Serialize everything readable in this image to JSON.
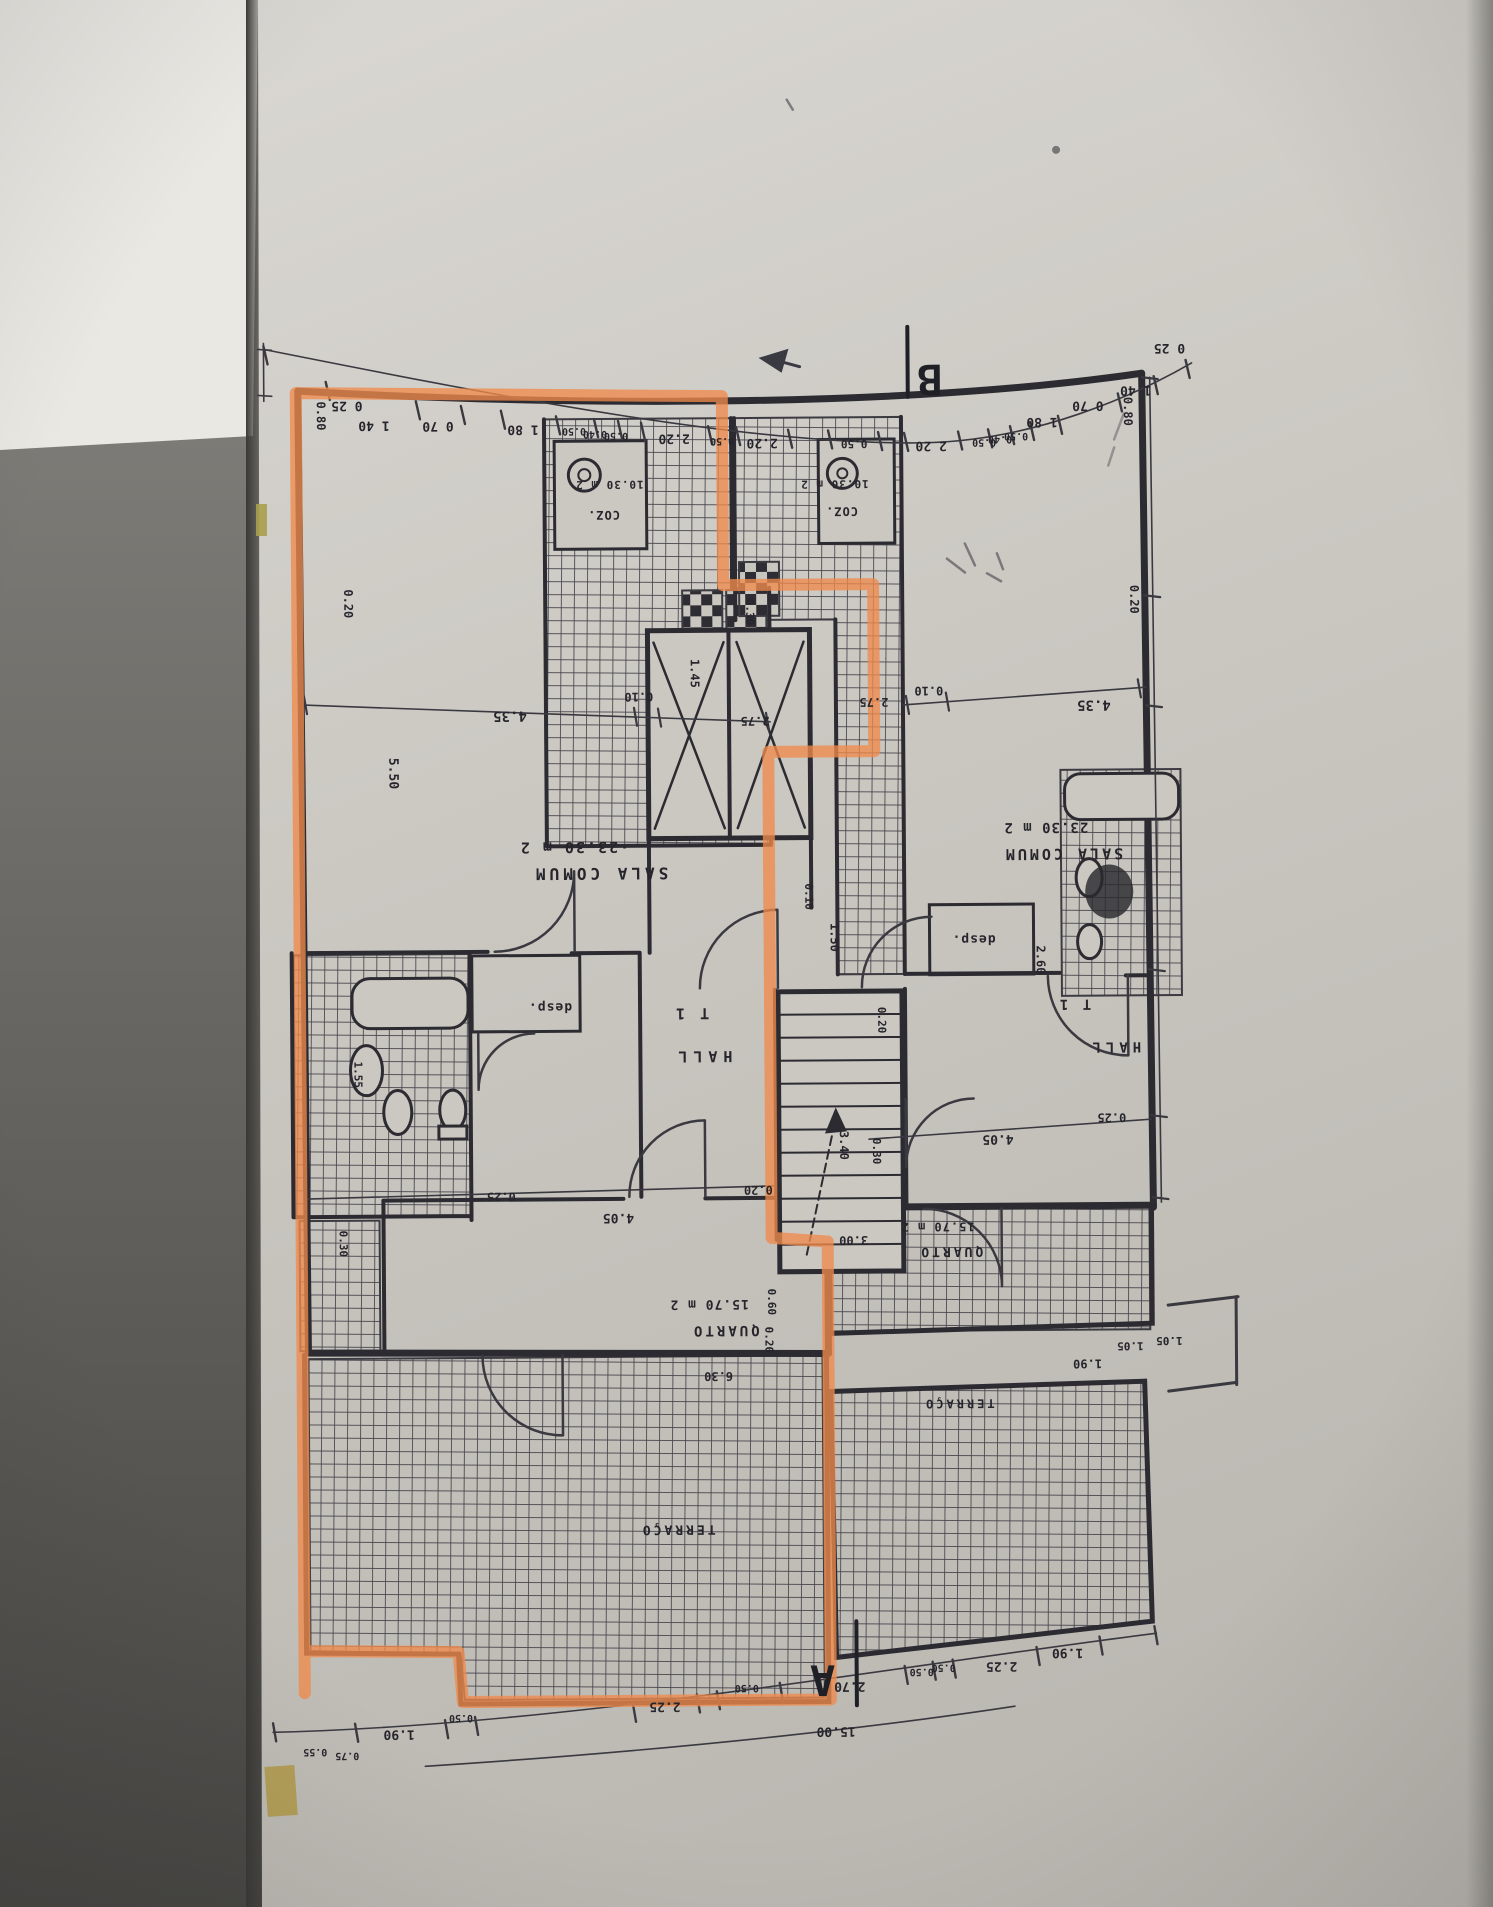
{
  "photo": {
    "highlight_color": "#ef8a4b",
    "ink_color": "#2c2b31",
    "paper_color": "#cbc8c2"
  },
  "plan": {
    "section_markers": [
      {
        "t": "B",
        "x": 934,
        "y": 366,
        "fs": 42
      },
      {
        "t": "A",
        "x": 818,
        "y": 1666,
        "fs": 42
      }
    ],
    "room_labels": [
      {
        "t": "SALA COMUM",
        "x": 601,
        "y": 867,
        "fs": 16,
        "ls": 4
      },
      {
        "t": "·23.30 m 2",
        "x": 575,
        "y": 841,
        "fs": 15,
        "ls": 2
      },
      {
        "t": "HALL",
        "x": 702,
        "y": 1051,
        "fs": 15,
        "ls": 6
      },
      {
        "t": "T 1",
        "x": 691,
        "y": 1008,
        "fs": 15,
        "ls": 3
      },
      {
        "t": "desp.",
        "x": 550,
        "y": 1002,
        "fs": 13,
        "ls": 1
      },
      {
        "t": "QUARTO",
        "x": 723,
        "y": 1326,
        "fs": 14,
        "ls": 3
      },
      {
        "t": "15.70 m 2",
        "x": 707,
        "y": 1300,
        "fs": 13,
        "ls": 1
      },
      {
        "t": "TERRAÇO",
        "x": 674,
        "y": 1525,
        "fs": 13,
        "ls": 3
      },
      {
        "t": "COZ.",
        "x": 607,
        "y": 510,
        "fs": 12,
        "ls": 1
      },
      {
        "t": "10.30 m 2",
        "x": 613,
        "y": 480,
        "fs": 11,
        "ls": 1
      },
      {
        "t": "SALA COMUM",
        "x": 1064,
        "y": 851,
        "fs": 15,
        "ls": 3
      },
      {
        "t": "23.30 m 2",
        "x": 1047,
        "y": 825,
        "fs": 14,
        "ls": 1
      },
      {
        "t": "HALL",
        "x": 1114,
        "y": 1045,
        "fs": 14,
        "ls": 5
      },
      {
        "t": "T 1",
        "x": 1074,
        "y": 1002,
        "fs": 14,
        "ls": 3
      },
      {
        "t": "desp.",
        "x": 974,
        "y": 937,
        "fs": 13,
        "ls": 1
      },
      {
        "t": "QUARTO",
        "x": 949,
        "y": 1249,
        "fs": 13,
        "ls": 3
      },
      {
        "t": "15.70 m 2",
        "x": 936,
        "y": 1224,
        "fs": 12,
        "ls": 1
      },
      {
        "t": "TERRAÇO",
        "x": 956,
        "y": 1401,
        "fs": 12,
        "ls": 3
      },
      {
        "t": "COZ.",
        "x": 845,
        "y": 508,
        "fs": 12,
        "ls": 1
      },
      {
        "t": "10.30 m 2",
        "x": 838,
        "y": 481,
        "fs": 11,
        "ls": 1
      }
    ],
    "dim_labels": [
      {
        "t": "0 25",
        "x": 351,
        "y": 399,
        "fs": 13
      },
      {
        "t": "1 40",
        "x": 378,
        "y": 419,
        "fs": 13
      },
      {
        "t": "0 70",
        "x": 442,
        "y": 420,
        "fs": 13
      },
      {
        "t": "1 80",
        "x": 527,
        "y": 424,
        "fs": 13
      },
      {
        "t": "0.50",
        "x": 578,
        "y": 427,
        "fs": 10
      },
      {
        "t": "0.40",
        "x": 599,
        "y": 430,
        "fs": 10
      },
      {
        "t": "0.50",
        "x": 620,
        "y": 432,
        "fs": 10
      },
      {
        "t": "2.20",
        "x": 678,
        "y": 434,
        "fs": 13
      },
      {
        "t": "0.50",
        "x": 726,
        "y": 438,
        "fs": 10
      },
      {
        "t": "2.20",
        "x": 766,
        "y": 439,
        "fs": 13
      },
      {
        "t": "0.50",
        "x": 858,
        "y": 441,
        "fs": 11
      },
      {
        "t": "2 20",
        "x": 935,
        "y": 443,
        "fs": 13
      },
      {
        "t": "0.50",
        "x": 988,
        "y": 441,
        "fs": 10
      },
      {
        "t": "0.40",
        "x": 1004,
        "y": 438,
        "fs": 10
      },
      {
        "t": "0.50",
        "x": 1020,
        "y": 435,
        "fs": 10
      },
      {
        "t": "1 80",
        "x": 1046,
        "y": 420,
        "fs": 13
      },
      {
        "t": "0 70",
        "x": 1092,
        "y": 404,
        "fs": 13
      },
      {
        "t": "1 40",
        "x": 1140,
        "y": 389,
        "fs": 13
      },
      {
        "t": "0 25",
        "x": 1174,
        "y": 347,
        "fs": 13
      },
      {
        "t": "0.80",
        "x": 321,
        "y": 413,
        "fs": 12,
        "r": 90
      },
      {
        "t": "0.20",
        "x": 347,
        "y": 601,
        "fs": 12,
        "r": 90
      },
      {
        "t": "5.50",
        "x": 391,
        "y": 771,
        "fs": 13,
        "r": 90
      },
      {
        "t": "1.55",
        "x": 354,
        "y": 1072,
        "fs": 11,
        "r": 90
      },
      {
        "t": "0.30",
        "x": 338,
        "y": 1241,
        "fs": 11,
        "r": 90
      },
      {
        "t": "4.35",
        "x": 512,
        "y": 710,
        "fs": 14
      },
      {
        "t": "0.10",
        "x": 641,
        "y": 692,
        "fs": 12
      },
      {
        "t": "2.75",
        "x": 757,
        "y": 717,
        "fs": 12
      },
      {
        "t": "0.30",
        "x": 749,
        "y": 612,
        "fs": 11,
        "r": 90
      },
      {
        "t": "1.45",
        "x": 693,
        "y": 673,
        "fs": 12,
        "r": 90
      },
      {
        "t": "0.10",
        "x": 806,
        "y": 897,
        "fs": 11,
        "r": 90
      },
      {
        "t": "1.50",
        "x": 831,
        "y": 938,
        "fs": 12,
        "r": 90
      },
      {
        "t": "0.20",
        "x": 878,
        "y": 1021,
        "fs": 11,
        "r": 90
      },
      {
        "t": "3.40",
        "x": 839,
        "y": 1146,
        "fs": 12,
        "r": 90
      },
      {
        "t": "3.00",
        "x": 852,
        "y": 1237,
        "fs": 12
      },
      {
        "t": "0.20",
        "x": 757,
        "y": 1186,
        "fs": 12
      },
      {
        "t": "0.60",
        "x": 766,
        "y": 1302,
        "fs": 11,
        "r": 90
      },
      {
        "t": "0.20",
        "x": 763,
        "y": 1340,
        "fs": 11,
        "r": 90
      },
      {
        "t": "6.30",
        "x": 716,
        "y": 1372,
        "fs": 12
      },
      {
        "t": "2.75",
        "x": 876,
        "y": 699,
        "fs": 12
      },
      {
        "t": "0.10",
        "x": 931,
        "y": 688,
        "fs": 12
      },
      {
        "t": "4.35",
        "x": 1096,
        "y": 703,
        "fs": 14
      },
      {
        "t": "0.20",
        "x": 1133,
        "y": 602,
        "fs": 12,
        "r": 90
      },
      {
        "t": "0.80",
        "x": 1128,
        "y": 414,
        "fs": 12,
        "r": 90
      },
      {
        "t": "2.60",
        "x": 1037,
        "y": 962,
        "fs": 12,
        "r": 90
      },
      {
        "t": "0.30",
        "x": 872,
        "y": 1152,
        "fs": 11,
        "r": 90
      },
      {
        "t": "4.05",
        "x": 997,
        "y": 1137,
        "fs": 13
      },
      {
        "t": "0.25",
        "x": 1111,
        "y": 1116,
        "fs": 12
      },
      {
        "t": "0.25",
        "x": 500,
        "y": 1191,
        "fs": 12
      },
      {
        "t": "4.05",
        "x": 617,
        "y": 1213,
        "fs": 13
      },
      {
        "t": "0.55",
        "x": 310,
        "y": 1746,
        "fs": 10
      },
      {
        "t": "0.75",
        "x": 342,
        "y": 1750,
        "fs": 10
      },
      {
        "t": "1.90",
        "x": 394,
        "y": 1728,
        "fs": 13
      },
      {
        "t": "0.50",
        "x": 456,
        "y": 1713,
        "fs": 10
      },
      {
        "t": "2.25",
        "x": 660,
        "y": 1702,
        "fs": 13
      },
      {
        "t": "0.50",
        "x": 742,
        "y": 1685,
        "fs": 10
      },
      {
        "t": "2.70",
        "x": 845,
        "y": 1683,
        "fs": 13
      },
      {
        "t": "0.50",
        "x": 917,
        "y": 1670,
        "fs": 10
      },
      {
        "t": "0.50",
        "x": 939,
        "y": 1666,
        "fs": 10
      },
      {
        "t": "2.25",
        "x": 997,
        "y": 1664,
        "fs": 13
      },
      {
        "t": "1.90",
        "x": 1063,
        "y": 1651,
        "fs": 13
      },
      {
        "t": "15.00",
        "x": 831,
        "y": 1728,
        "fs": 13
      },
      {
        "t": "1.90",
        "x": 1085,
        "y": 1362,
        "fs": 12
      },
      {
        "t": "1.05",
        "x": 1128,
        "y": 1345,
        "fs": 11
      },
      {
        "t": "1.05",
        "x": 1167,
        "y": 1340,
        "fs": 11
      }
    ]
  }
}
